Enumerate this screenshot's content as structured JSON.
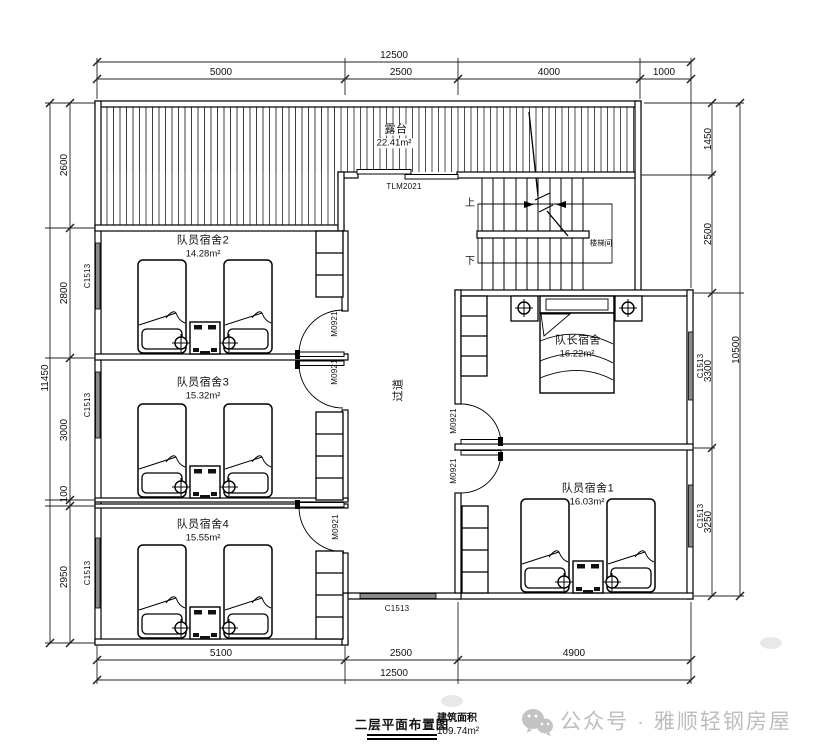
{
  "plan": {
    "rooms": {
      "terrace": {
        "name": "露台",
        "area": "22.41m²"
      },
      "dorm2": {
        "name": "队员宿舍2",
        "area": "14.28m²"
      },
      "dorm3": {
        "name": "队员宿舍3",
        "area": "15.32m²"
      },
      "dorm4": {
        "name": "队员宿舍4",
        "area": "15.55m²"
      },
      "captain": {
        "name": "队长宿舍",
        "area": "16.22m²"
      },
      "dorm1": {
        "name": "队员宿舍1",
        "area": "16.03m²"
      },
      "corridor": {
        "name": "过道"
      },
      "stairwell": {
        "name": "楼梯间"
      }
    },
    "stairs": {
      "up": "上",
      "down": "下"
    },
    "labels": {
      "door": "M0921",
      "window": "C1513",
      "terrace_door": "TLM2021"
    }
  },
  "dimensions": {
    "top": {
      "total": "12500",
      "segments": [
        "5000",
        "2500",
        "4000",
        "1000"
      ]
    },
    "bottom": {
      "total": "12500",
      "segments": [
        "5100",
        "2500",
        "4900"
      ]
    },
    "left": {
      "total": "11450",
      "segments": [
        "2600",
        "2800",
        "3000",
        "100",
        "2950"
      ]
    },
    "right": {
      "total": "10500",
      "segments": [
        "1450",
        "2500",
        "3300",
        "3250"
      ]
    }
  },
  "title_block": {
    "drawing_title": "二层平面布置图",
    "area_caption": "建筑面积",
    "area_value": "109.74m²"
  },
  "watermark": {
    "text": "公众号 · 雅顺轻钢房屋"
  },
  "colors": {
    "line": "#111111",
    "window_fill": "#8a8a8a",
    "watermark": "#bdbdbd"
  }
}
